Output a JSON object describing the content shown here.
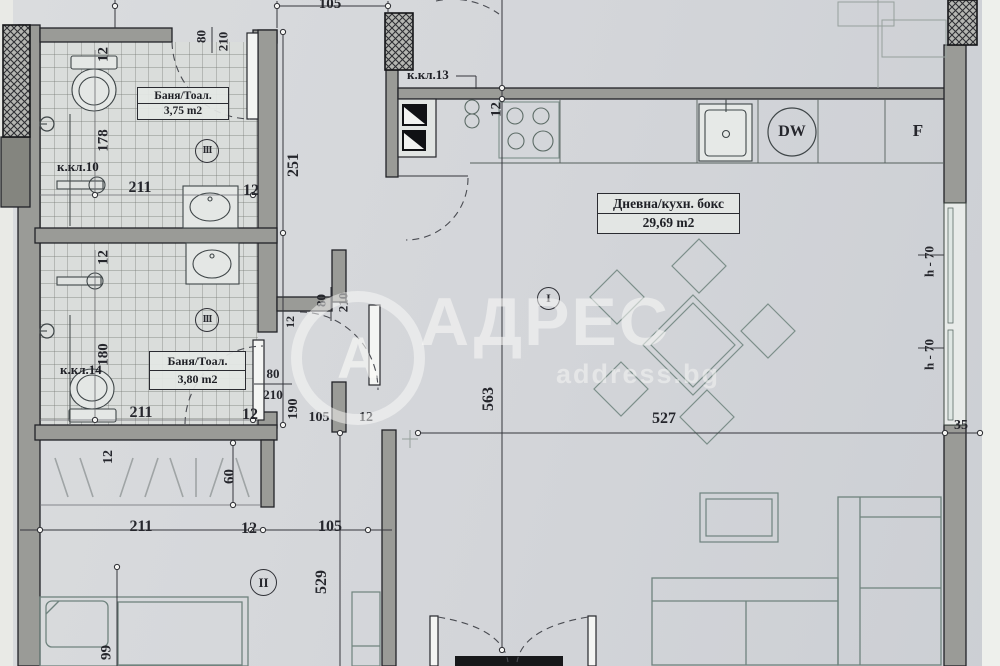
{
  "watermark": {
    "brand": "АДРЕС",
    "site": "address.bg",
    "logo_letter": "А"
  },
  "rooms": {
    "bath1": {
      "name": "Баня/Тоал.",
      "area": "3,75 m2",
      "index": "III"
    },
    "bath2": {
      "name": "Баня/Тоал.",
      "area": "3,80 m2",
      "index": "III"
    },
    "living": {
      "name": "Дневна/кухн. бокс",
      "area": "29,69 m2",
      "index": "I"
    },
    "bedroom": {
      "index": "II"
    }
  },
  "shafts": {
    "k10": "к.кл.10",
    "k13": "к.кл.13",
    "k14": "к.кл.14"
  },
  "appliances": {
    "dishwasher": "DW",
    "fridge": "F"
  },
  "dimensions": {
    "top_corridor_105": "105",
    "bath1_wall_12": "12",
    "bath1_door_w": "80",
    "bath1_door_h": "210",
    "bath1_depth_178": "178",
    "bath1_len_211": "211",
    "bath1_wall2_12": "12",
    "corridor_251": "251",
    "bath2_wall_12": "12",
    "bath2_depth_180": "180",
    "bath2_len_211": "211",
    "bath2_wall2_12": "12",
    "bath2_door_w": "80",
    "bath2_door_h": "210",
    "hall_door_w": "80",
    "hall_door_h": "210",
    "hall_wall_12": "12",
    "niche_190": "190",
    "niche_105": "105",
    "niche_12": "12",
    "kitchen_wall_12": "12",
    "living_depth_563": "563",
    "living_width_527": "527",
    "right_wall_35": "35",
    "window_h70_a": "h - 70",
    "window_h70_b": "h - 70",
    "closet_wall_12": "12",
    "closet_depth_60": "60",
    "bottom_211": "211",
    "bottom_12": "12",
    "bottom_105": "105",
    "bedroom_depth_529": "529",
    "bed_width_99": "99"
  }
}
